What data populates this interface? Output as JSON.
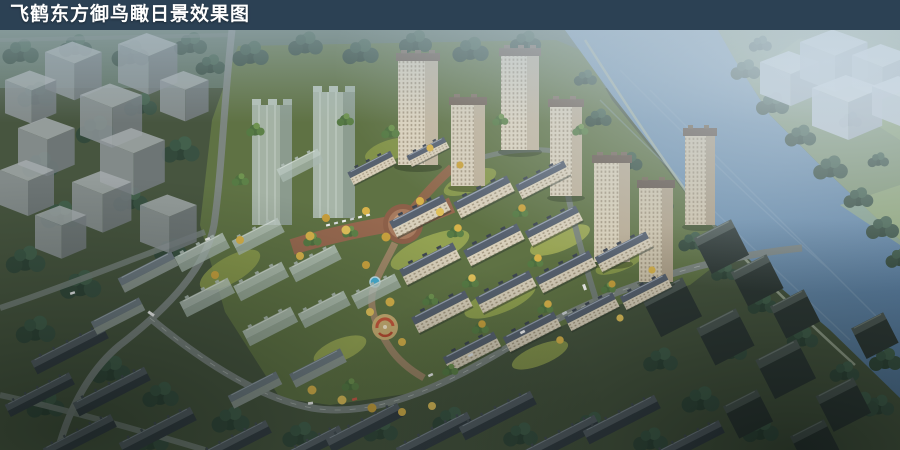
{
  "title_bar": {
    "text": "飞鹤东方御鸟瞰日景效果图",
    "bg_color": "#2c4154",
    "text_color": "#ffffff"
  },
  "scene": {
    "type": "architectural-aerial-rendering",
    "elements": {
      "river": "river running diagonally along upper-right",
      "development": "residential towers and apartment rows with central landscaped axis",
      "plaza": "circular plaza with blue fountain",
      "context": "surrounding city blocks shown dark / as translucent massing volumes"
    },
    "palette": {
      "river": "#6b8dab",
      "river_deep": "#54779a",
      "haze": "#bccbd7",
      "context_tree": "#2f4437",
      "site_tree": "#5d8148",
      "autumn_tree": "#d7b24a",
      "site_lawn": "#9dab55",
      "site_ground": "#5f7244",
      "facade_cream": "#d8cfba",
      "roof_slate": "#57616f",
      "tower_roof": "#6e5f52",
      "glass_massing": "#b3c1ba",
      "context_massing": "#a6acae",
      "context_dark_wall": "#343d44",
      "context_dark_roof": "#565f66",
      "road": "#7d8683",
      "boulevard": "#96684f",
      "fountain": "#47aed2",
      "parterre_accent": "#c4563b"
    }
  }
}
